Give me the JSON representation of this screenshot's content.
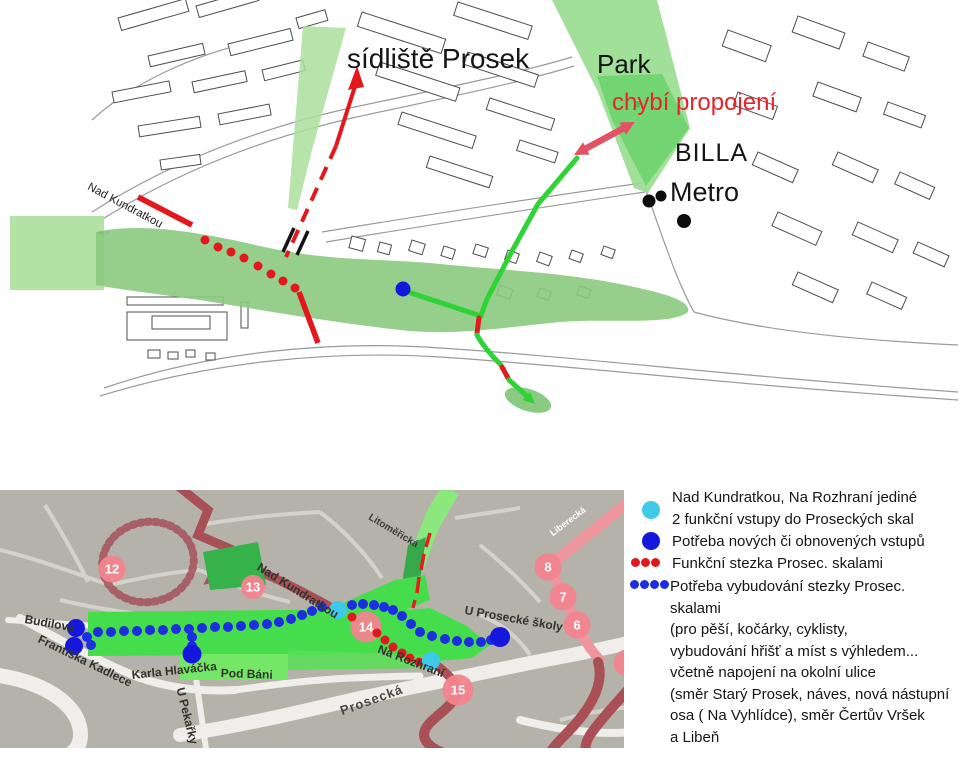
{
  "top_map": {
    "labels": {
      "sidliste_prosek": "sídliště Prosek",
      "park": "Park",
      "chybi_propojeni": "chybí propojení",
      "billa": "BILLA",
      "metro": "Metro",
      "nad_kundratkou": "Nad Kundratkou"
    },
    "markers": {
      "red_trail_dots": [
        [
          205,
          240
        ],
        [
          218,
          247
        ],
        [
          231,
          252
        ],
        [
          244,
          258
        ],
        [
          258,
          266
        ],
        [
          271,
          274
        ],
        [
          283,
          281
        ],
        [
          295,
          288
        ]
      ],
      "metro_entrance_dots": [
        [
          649,
          201,
          6.5
        ],
        [
          661,
          196,
          5.5
        ],
        [
          684,
          221,
          7
        ]
      ],
      "entry_point_blue": [
        [
          403,
          289,
          7.5
        ]
      ]
    }
  },
  "bottom_map": {
    "streets": {
      "budilova": "Budilova",
      "frantiska_kadlece": "Františka Kadlece",
      "karla_hlavacka": "Karla Hlaváčka",
      "u_pekarky": "U Pekařky",
      "pod_bani": "Pod Báni",
      "nad_kundratkou": "Nad Kundratkou",
      "litomericka": "Litoměřická",
      "u_prosecke_skoly": "U Prosecké školy",
      "na_rozhrani": "Na Rozhraní",
      "prosecka": "Prosecká",
      "liberecka": "Liberecká"
    },
    "stops": [
      {
        "n": "12",
        "x": 112,
        "y": 79,
        "s": 27
      },
      {
        "n": "13",
        "x": 253,
        "y": 97,
        "s": 24
      },
      {
        "n": "14",
        "x": 366,
        "y": 137,
        "s": 31
      },
      {
        "n": "15",
        "x": 458,
        "y": 200,
        "s": 31
      },
      {
        "n": "8",
        "x": 548,
        "y": 77,
        "s": 27
      },
      {
        "n": "7",
        "x": 563,
        "y": 107,
        "s": 27
      },
      {
        "n": "6",
        "x": 577,
        "y": 135,
        "s": 27
      },
      {
        "n": "5",
        "x": 627,
        "y": 173,
        "s": 27
      }
    ],
    "markers": {
      "functional_entries_cyan": [
        [
          338,
          120,
          9
        ],
        [
          431,
          171,
          9
        ]
      ],
      "needed_entries_blue": [
        [
          76,
          138,
          9
        ],
        [
          74,
          156,
          9
        ],
        [
          192,
          164,
          9.5
        ],
        [
          500,
          147,
          10
        ]
      ],
      "planned_trail_blue_dots": [
        [
          87,
          147
        ],
        [
          91,
          155
        ],
        [
          98,
          142
        ],
        [
          111,
          142
        ],
        [
          124,
          141
        ],
        [
          137,
          141
        ],
        [
          150,
          140
        ],
        [
          163,
          140
        ],
        [
          176,
          139
        ],
        [
          189,
          139
        ],
        [
          202,
          138
        ],
        [
          215,
          137
        ],
        [
          228,
          137
        ],
        [
          241,
          136
        ],
        [
          254,
          135
        ],
        [
          267,
          134
        ],
        [
          279,
          132
        ],
        [
          291,
          129
        ],
        [
          302,
          125
        ],
        [
          312,
          121
        ],
        [
          322,
          117
        ],
        [
          352,
          115
        ],
        [
          363,
          114
        ],
        [
          374,
          115
        ],
        [
          384,
          117
        ],
        [
          393,
          120
        ],
        [
          402,
          126
        ],
        [
          411,
          134
        ],
        [
          420,
          142
        ],
        [
          432,
          146
        ],
        [
          445,
          149
        ],
        [
          457,
          151
        ],
        [
          469,
          152
        ],
        [
          481,
          152
        ],
        [
          491,
          150
        ],
        [
          192,
          147
        ],
        [
          192,
          156
        ]
      ],
      "functional_trail_red_dots": [
        [
          352,
          127
        ],
        [
          377,
          143
        ],
        [
          385,
          150
        ],
        [
          393,
          157
        ],
        [
          402,
          163
        ],
        [
          410,
          168
        ],
        [
          419,
          172
        ]
      ]
    }
  },
  "legend": {
    "items": [
      {
        "marker": "cyan-dot",
        "text": "Nad Kundratkou, Na Rozhraní jediné\n2 funkční vstupy do Proseckých skal"
      },
      {
        "marker": "blue-dot",
        "text": "Potřeba nových či obnovených vstupů"
      },
      {
        "marker": "red-dotted-line",
        "text": "Funkční stezka Prosec. skalami"
      },
      {
        "marker": "blue-dotted-line",
        "text": "Potřeba vybudování stezky Prosec. skalami\n(pro pěší, kočárky, cyklisty,\nvybudování hřišť a míst s výhledem...\nvčetně napojení na okolní ulice\n(směr Starý Prosek, náves, nová nástupní\nosa ( Na Vyhlídce), směr Čertův Vršek\na Libeň"
      }
    ]
  },
  "colors": {
    "annotation_red": "#e4171d",
    "missing_link_text_red": "#e8232b",
    "connection_arrow_pink": "#e25264",
    "route_green": "#2fd335",
    "entry_blue": "#1418dd",
    "entry_cyan": "#3fc9e8",
    "stop_circle_pink": "#f2848e",
    "greenery_bright": "#46dd4d",
    "map_background_gray": "#b5b2aa",
    "major_road_pink": "#ef959c",
    "major_road_dark_red": "#a85055"
  }
}
